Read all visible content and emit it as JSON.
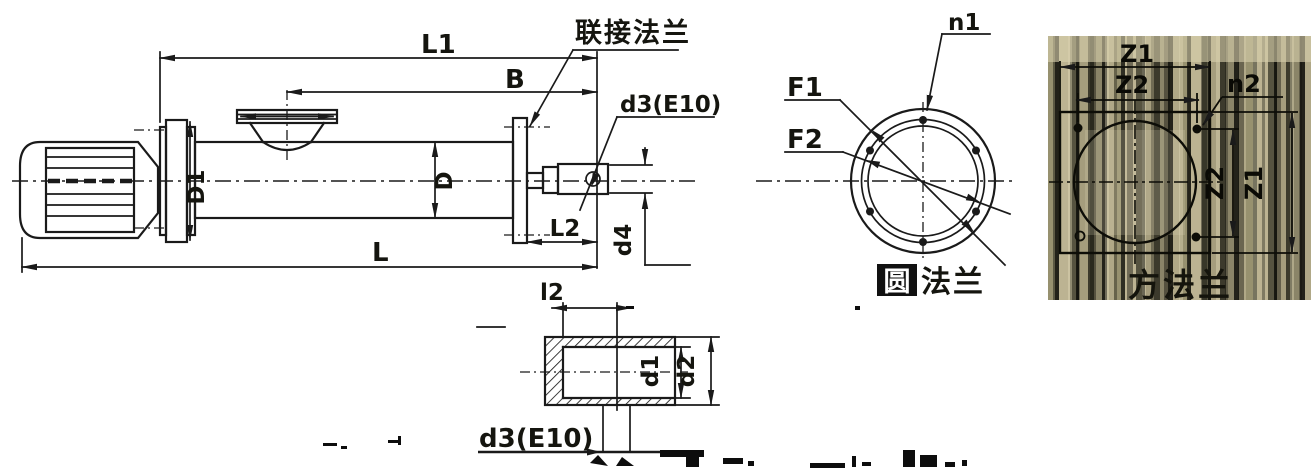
{
  "main_view": {
    "dim_l1": "L1",
    "dim_b": "B",
    "label_connecting_flange": "联接法兰",
    "dim_d3": "d3(E10)",
    "dim_d1": "D1",
    "dim_d": "D",
    "dim_l": "L",
    "dim_l2": "L2",
    "dim_d4": "d4"
  },
  "round_flange": {
    "dim_f1": "F1",
    "dim_f2": "F2",
    "dim_n1": "n1",
    "caption_first": "圆",
    "caption_rest": "法兰"
  },
  "square_flange": {
    "dim_z1_top": "Z1",
    "dim_z2_top": "Z2",
    "dim_n2": "n2",
    "dim_z2_right": "Z2",
    "dim_z1_right": "Z1",
    "caption": "方法兰"
  },
  "shaft_detail": {
    "dim_l2": "l2",
    "dim_d1": "d1",
    "dim_d2": "d2",
    "dim_d3": "d3(E10)"
  },
  "colors": {
    "line": "#1a1a1a",
    "background": "#ffffff",
    "noise_dark": "#4a483a",
    "noise_light": "#cfc7a6"
  }
}
